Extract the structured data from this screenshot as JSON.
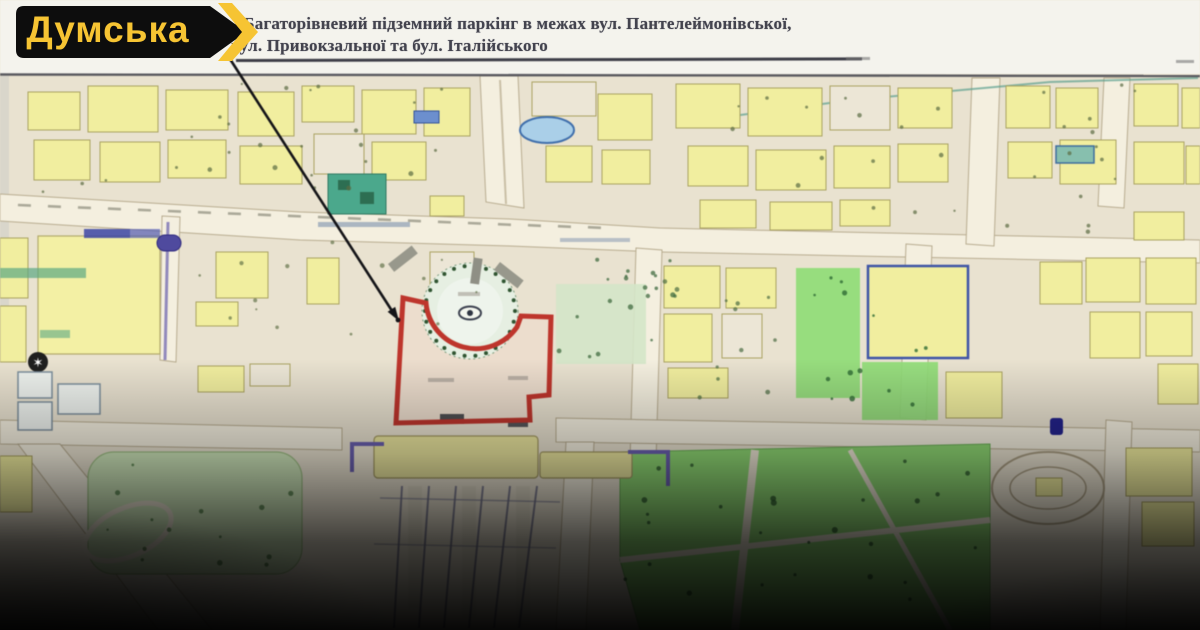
{
  "brand": {
    "name": "Думська",
    "colors": {
      "yellow": "#f6c433",
      "black": "#0d0d0d"
    }
  },
  "header": {
    "title_line1": ") Багаторівневий підземний паркінг в межах вул. Пантелеймонівської,",
    "title_line2": "вул. Привокзальної та бул. Італійського"
  },
  "map": {
    "kind": "scanned city master-plan with highlighted parking site",
    "colors": {
      "paper": "#f4f3ed",
      "background": "#e9e2cf",
      "building_yellow": "#f1ee9d",
      "road_cream": "#f4efdf",
      "park_green": "#8cd871",
      "plaza_green": "#e6efe2",
      "teal_square": "#49a98c",
      "water_blue": "#a9cfe9",
      "rail_purple": "#6a60b2",
      "highlight_red": "#c1342b",
      "arrow_black": "#141418"
    }
  }
}
